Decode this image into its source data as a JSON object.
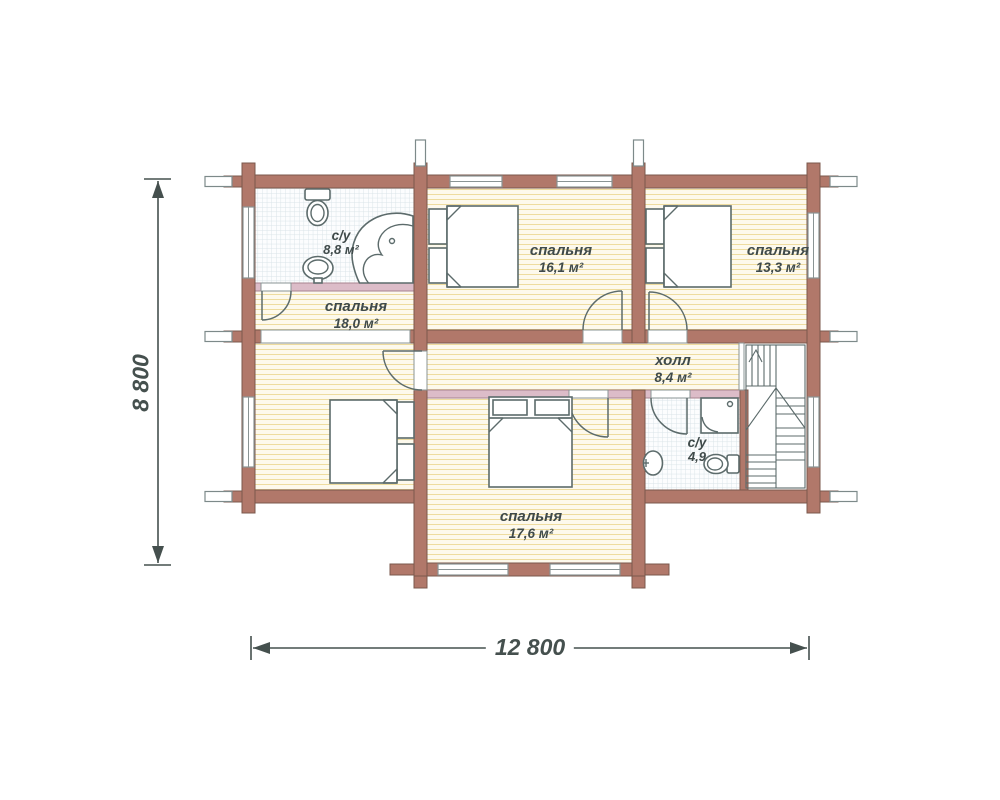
{
  "rooms": [
    {
      "id": "wc-top",
      "name": "с/у",
      "area": "8,8 м²"
    },
    {
      "id": "bedroom-161",
      "name": "спальня",
      "area": "16,1 м²"
    },
    {
      "id": "bedroom-133",
      "name": "спальня",
      "area": "13,3 м²"
    },
    {
      "id": "bedroom-180",
      "name": "спальня",
      "area": "18,0 м²"
    },
    {
      "id": "hall",
      "name": "холл",
      "area": "8,4 м²"
    },
    {
      "id": "bedroom-176",
      "name": "спальня",
      "area": "17,6 м²"
    },
    {
      "id": "wc-bottom",
      "name": "с/у",
      "area": "4,9"
    }
  ],
  "dimensions": {
    "width_label": "12 800",
    "height_label": "8 800"
  },
  "colors": {
    "wall_fill": "#b1786a",
    "wall_edge": "#7b584c",
    "partition_fill": "#dcbcc8",
    "partition_edge": "#a8838f",
    "floor_cream": "#fdf9ec",
    "hatch_line": "#eedc9f",
    "tile_bg": "#fcfdfe",
    "tile_line": "#d8e3e7",
    "line_color": "#5c6b6b",
    "text_color": "#3f4a4a",
    "dim_color": "#45504e"
  }
}
